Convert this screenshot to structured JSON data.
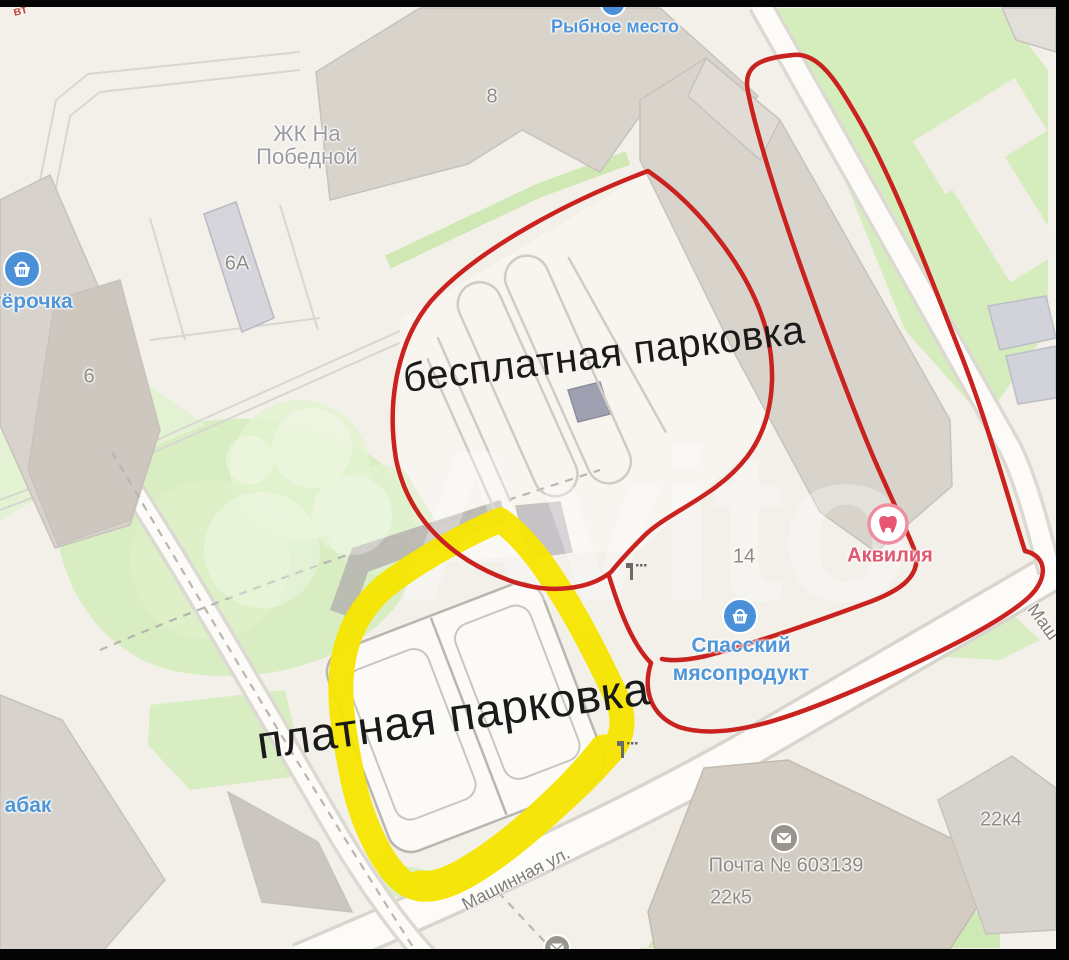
{
  "colors": {
    "annotation_red": "#c9221f",
    "annotation_yellow": "#f6e502",
    "annotation_black": "#1a1a1a",
    "poi_blue": "#4e95d9",
    "dental_pink": "#e0586f",
    "building_label_gray": "#8f8c86",
    "street_label_gray": "#7f7c77",
    "map_green": "#d8edc2",
    "building_gray": "#d8d4cc",
    "road_white": "#fcfbf8",
    "watermark_white": "#ffffff"
  },
  "annotations": {
    "free_parking_label": "бесплатная парковка",
    "paid_parking_label": "платная парковка"
  },
  "watermark": {
    "text": "Avito"
  },
  "poi": {
    "rybnoe_mesto": "Рыбное место",
    "pyaterochka_partial": "тёрочка",
    "tabak_partial": "абак",
    "akvilia": "Аквилия",
    "spassky_line1": "Спасский",
    "spassky_line2": "мясопродукт",
    "pochta": "Почта № 603139",
    "red_fragment": "вт"
  },
  "buildings": {
    "b8": "8",
    "b6a": "6А",
    "b6": "6",
    "b14": "14",
    "b22k4": "22к4",
    "b22k5": "22к5",
    "zhk_line1": "ЖК На",
    "zhk_line2": "Победной"
  },
  "streets": {
    "mashinnaya": "Машинная ул.",
    "mashinnaya_partial": "Маш"
  }
}
